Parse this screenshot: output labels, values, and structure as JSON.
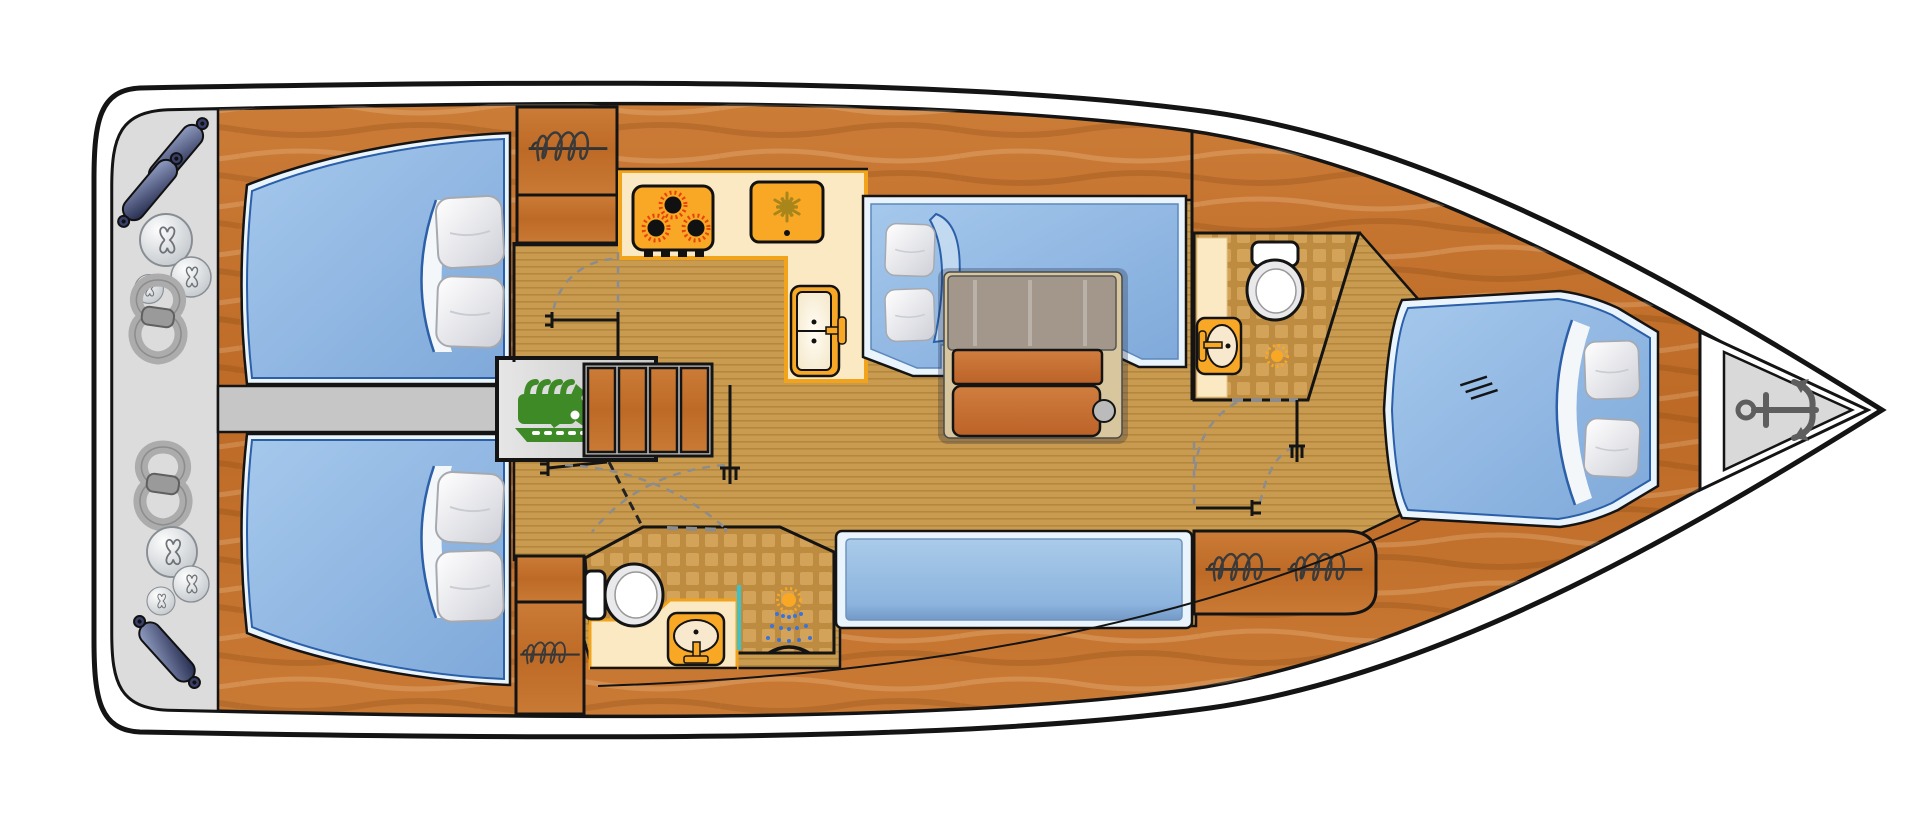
{
  "diagram": {
    "type": "yacht-interior-floor-plan",
    "view": "top-down",
    "orientation": {
      "bow": "right",
      "stern": "left"
    },
    "areas": {
      "stern_platform": {
        "label": "Stern platform",
        "equipment": [
          "fender",
          "fender",
          "fender balls",
          "mooring rope coil",
          "mooring rope coil",
          "fender balls",
          "fender"
        ]
      },
      "aft_cabin_port": {
        "label": "Aft cabin (port)",
        "furniture": [
          "double berth",
          "pillow",
          "pillow",
          "folded blanket"
        ]
      },
      "aft_cabin_starboard": {
        "label": "Aft cabin (starboard)",
        "furniture": [
          "double berth",
          "pillow",
          "pillow",
          "folded blanket"
        ]
      },
      "companionway": {
        "label": "Companionway",
        "furniture": [
          "engine compartment",
          "companionway steps (4)"
        ]
      },
      "galley": {
        "label": "Galley",
        "appliances": [
          "3-burner stove",
          "refrigerator",
          "twin sink with faucet"
        ]
      },
      "salon": {
        "label": "Salon",
        "furniture": [
          "U-shaped sofa",
          "folding table with two leaves",
          "bench seat"
        ]
      },
      "aft_head": {
        "label": "Aft head with shower",
        "fixtures": [
          "toilet",
          "washbasin",
          "shower head",
          "shower screen",
          "tiled floor"
        ]
      },
      "forward_head": {
        "label": "Forward head (starboard)",
        "fixtures": [
          "toilet",
          "washbasin",
          "floor drain",
          "tiled floor"
        ]
      },
      "hanging_lockers": {
        "label": "Hanging lockers (wardrobes)",
        "count": 4
      },
      "forward_cabin": {
        "label": "Forward cabin",
        "furniture": [
          "V-berth",
          "pillow",
          "pillow",
          "folded blanket"
        ]
      },
      "anchor_locker": {
        "label": "Anchor locker",
        "equipment": [
          "anchor"
        ]
      }
    },
    "icons": [
      "hanging-locker-coil-icon",
      "stove-burner-icon",
      "snowflake-fridge-icon",
      "sink-icon",
      "toilet-icon",
      "shower-spray-icon",
      "floor-drain-icon",
      "engine-icon",
      "anchor-icon",
      "door-swing-arc",
      "door-post-icon"
    ],
    "palette": {
      "hull_stroke": "#141414",
      "deck_white": "#ffffff",
      "platform_gray": "#dcdcdc",
      "wood": "#c4722e",
      "floor": "#c99b51",
      "tile": "#be8c41",
      "counter": "#fbe9c3",
      "counter_edge": "#f2a31c",
      "appliance": "#f9a825",
      "burner_ring": "#e8420a",
      "mattress_blue": "#8fb9e2",
      "mattress_edge": "#2b5fa8",
      "bedding_white": "#eaf4fc",
      "divider_gray": "#c6c6c6",
      "engine_green": "#3e8a26",
      "anchor_gray": "#5e5e5e",
      "shower_screen_teal": "#3fc1c9",
      "fender_navy": "#29325c",
      "rope_gray": "#acacac",
      "snowflake_olive": "#a8861b"
    }
  }
}
